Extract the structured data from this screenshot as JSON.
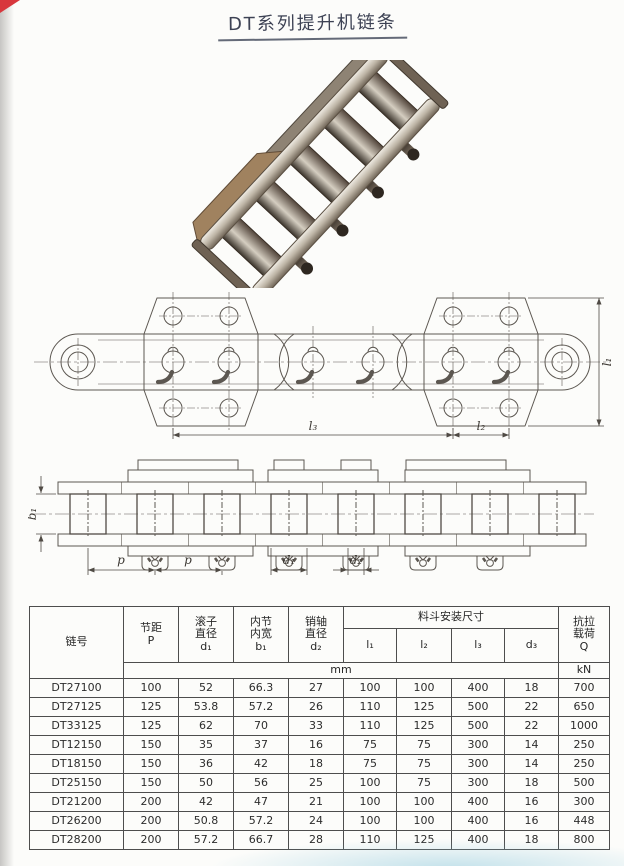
{
  "page": {
    "title": "DT系列提升机链条"
  },
  "drawings": {
    "top_view": {
      "dim_l1": "l₁",
      "dim_l2": "l₂",
      "dim_l3": "l₃"
    },
    "side_view": {
      "dim_b1": "b₁",
      "dim_p_left": "p",
      "dim_p_right": "p",
      "dim_d1": "d₁",
      "dim_d2": "d₂"
    }
  },
  "table": {
    "headers": {
      "chain_no": "链号",
      "pitch": "节距\nP",
      "roller_dia": "滚子\n直径\nd₁",
      "inner_width": "内节\n内宽\nb₁",
      "pin_dia": "销轴\n直径\nd₂",
      "bucket_dims": "料斗安装尺寸",
      "l1": "l₁",
      "l2": "l₂",
      "l3": "l₃",
      "d3": "d₃",
      "tensile": "抗拉\n载荷\nQ",
      "unit_mm": "mm",
      "unit_kn": "kN"
    },
    "rows": [
      [
        "DT27100",
        "100",
        "52",
        "66.3",
        "27",
        "100",
        "100",
        "400",
        "18",
        "700"
      ],
      [
        "DT27125",
        "125",
        "53.8",
        "57.2",
        "26",
        "110",
        "125",
        "500",
        "22",
        "650"
      ],
      [
        "DT33125",
        "125",
        "62",
        "70",
        "33",
        "110",
        "125",
        "500",
        "22",
        "1000"
      ],
      [
        "DT12150",
        "150",
        "35",
        "37",
        "16",
        "75",
        "75",
        "300",
        "14",
        "250"
      ],
      [
        "DT18150",
        "150",
        "36",
        "42",
        "18",
        "75",
        "75",
        "300",
        "14",
        "250"
      ],
      [
        "DT25150",
        "150",
        "50",
        "56",
        "25",
        "100",
        "75",
        "300",
        "18",
        "500"
      ],
      [
        "DT21200",
        "200",
        "42",
        "47",
        "21",
        "100",
        "100",
        "400",
        "16",
        "300"
      ],
      [
        "DT26200",
        "200",
        "50.8",
        "57.2",
        "24",
        "100",
        "100",
        "400",
        "16",
        "448"
      ],
      [
        "DT28200",
        "200",
        "57.2",
        "66.7",
        "28",
        "110",
        "125",
        "400",
        "18",
        "800"
      ]
    ]
  }
}
